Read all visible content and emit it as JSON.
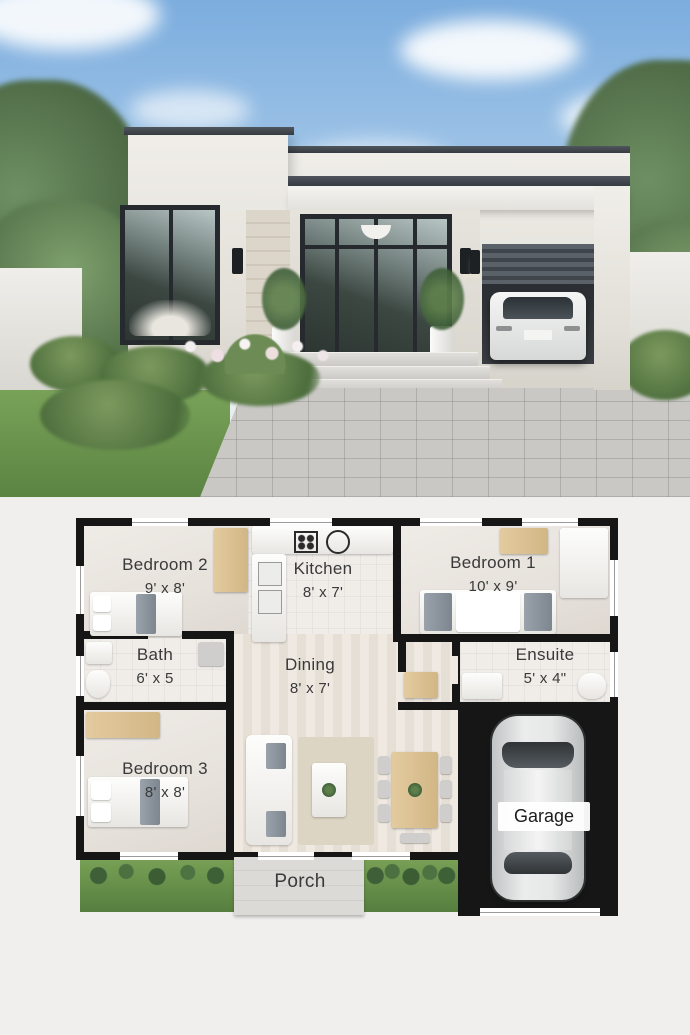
{
  "meta": {
    "description": "Modern single-storey house: photorealistic exterior render above a 3D floor plan",
    "sections": [
      "exterior-render",
      "floor-plan"
    ]
  },
  "palette": {
    "sky": "#7cadde",
    "house_wall": "#e9e6df",
    "fascia_dark": "#3a4046",
    "plan_background": "#f0efed",
    "plan_wall": "#161616",
    "room_floor": "#e9e4de",
    "garage_floor": "#b7bbbd",
    "grass": "#6a9350",
    "wood_accent": "#d9bf93"
  },
  "plan": {
    "rooms": {
      "bedroom2": {
        "name": "Bedroom 2",
        "dims": "9' x 8'"
      },
      "kitchen": {
        "name": "Kitchen",
        "dims": "8' x 7'"
      },
      "bedroom1": {
        "name": "Bedroom 1",
        "dims": "10' x 9'"
      },
      "bath": {
        "name": "Bath",
        "dims": "6' x 5"
      },
      "dining": {
        "name": "Dining",
        "dims": "8' x 7'"
      },
      "ensuite": {
        "name": "Ensuite",
        "dims": "5' x 4\""
      },
      "bedroom3": {
        "name": "Bedroom 3",
        "dims": "8' x 8'"
      },
      "garage": {
        "name": "Garage"
      },
      "porch": {
        "name": "Porch"
      }
    }
  }
}
